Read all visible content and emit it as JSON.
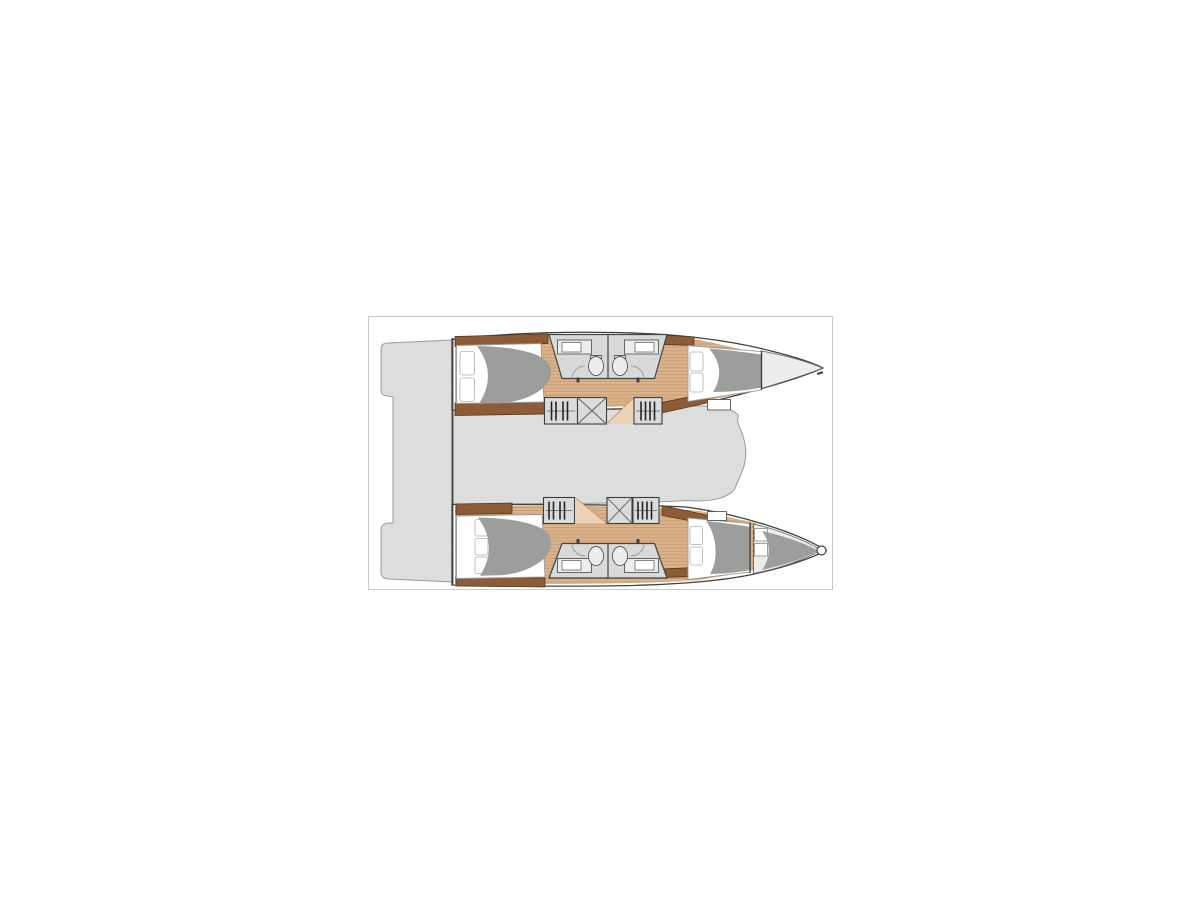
{
  "page": {
    "background": "#ffffff"
  },
  "plan": {
    "kind": "catamaran-deck-floor-plan",
    "orientation": "bow-right",
    "colors": {
      "frame": "#c9cbca",
      "outline": "#3f4140",
      "deck": "#dcdedd",
      "deckStroke": "#9a9c9b",
      "white": "#ffffff",
      "wood": "#dcb28a",
      "woodLine": "#c49a72",
      "woodLight": "#ecd3b8",
      "brown": "#8c5c39",
      "brownStroke": "#4f3018",
      "bedStroke": "#9b9b9b",
      "pillowStroke": "#b0b0b0",
      "duvet": "#9c9e9b",
      "bath": "#d8dad9",
      "bathStroke": "#424443",
      "fixture": "#eceeed",
      "fixStroke": "#565857",
      "arc": "#8a8c8b",
      "box": "#dadcdb",
      "boxStroke": "#3f3f3f",
      "rail": "#5a5c5b",
      "hanger": "#232423",
      "bow": "#eceeed",
      "bowStroke": "#6a6c6b"
    },
    "parts": [
      "plan-border",
      "stern-platform",
      "aft-crossbeam",
      "saloon-deck",
      "port-hull",
      "starboard-hull",
      "teak-floor",
      "aft-cabin-bed",
      "forward-cabin-bed",
      "pillows",
      "duvet",
      "bathroom",
      "sink-counter",
      "toilet",
      "door-swing",
      "hanging-locker",
      "companionway-stairs",
      "step",
      "forepeak-berth",
      "forepeak-shelves",
      "bow-roller"
    ]
  }
}
